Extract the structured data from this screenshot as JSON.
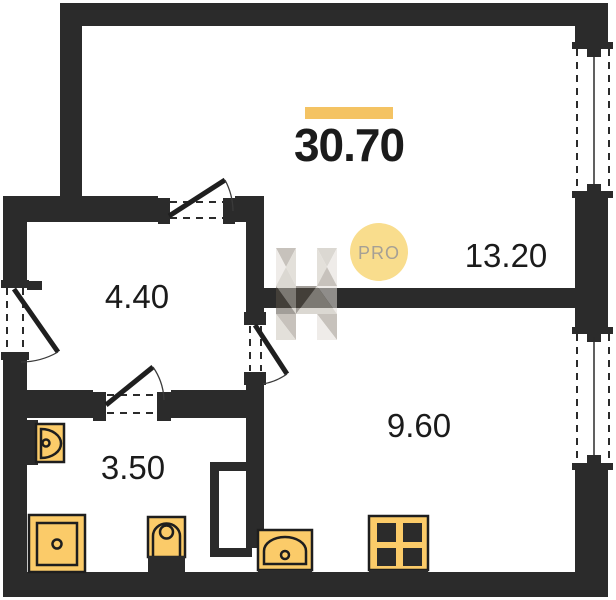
{
  "plan": {
    "total_area": "30.70",
    "rooms": [
      {
        "id": "living-room",
        "area": "13.20"
      },
      {
        "id": "hallway",
        "area": "4.40"
      },
      {
        "id": "bathroom",
        "area": "3.50"
      },
      {
        "id": "kitchen-living",
        "area": "9.60"
      }
    ],
    "badge": "PRO",
    "colors": {
      "wall": "#2b2b2b",
      "accent_bar": "#f4c363",
      "fixture_fill": "#fbcb69",
      "fixture_stroke": "#1e1e1e",
      "badge_fill": "#f9dd8d",
      "badge_text": "#a6a095",
      "label_text": "#1b1b1b",
      "watermark_tones": [
        "#e2ded8",
        "#bfb9ae",
        "#9a9286",
        "#575046",
        "#cdc7bd"
      ]
    }
  }
}
